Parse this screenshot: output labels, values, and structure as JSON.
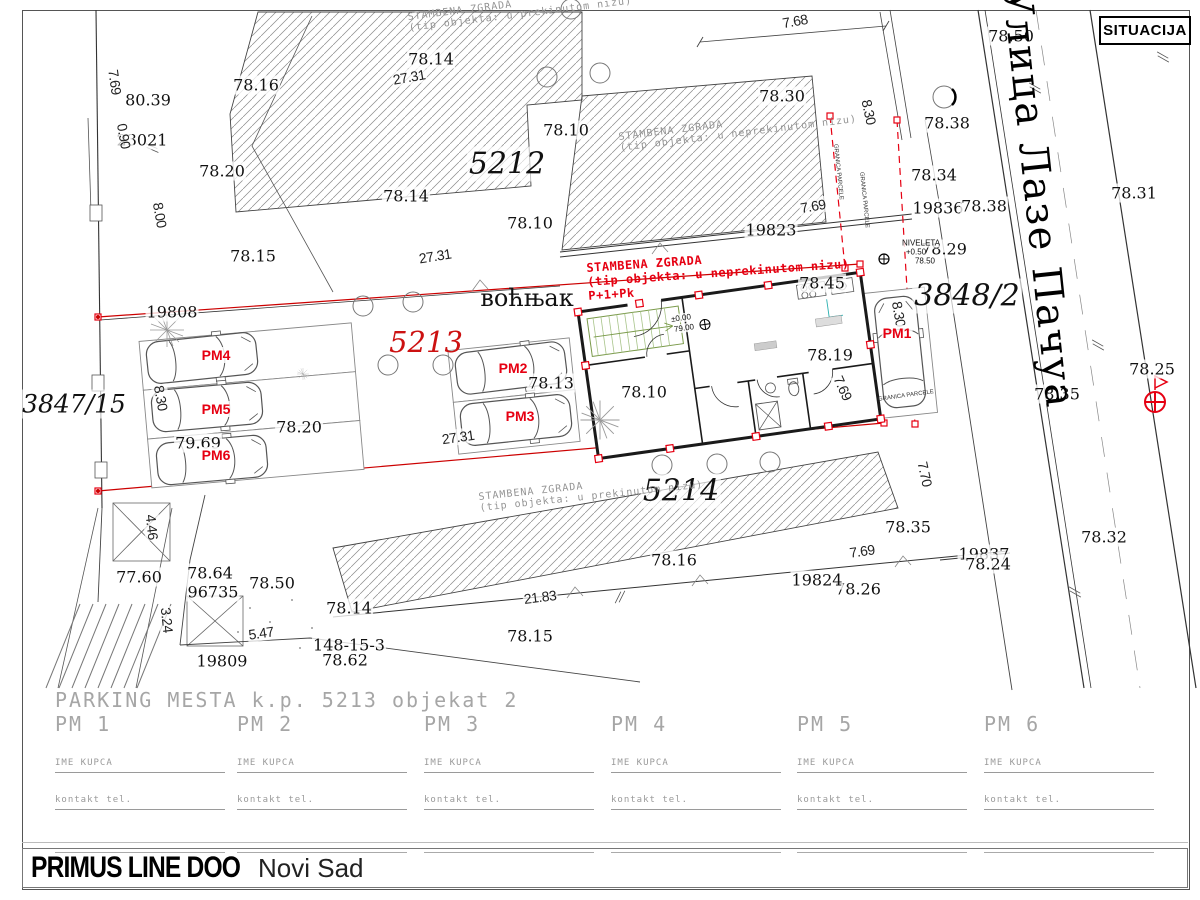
{
  "header": {
    "label": "SITUACIJA"
  },
  "street": {
    "name": "Улица Лазе Пачуа"
  },
  "colors": {
    "red": "#e60012",
    "parcel_red": "#cc1111",
    "boundary_red": "#cc0000",
    "hatch": "#777",
    "green": "#7a9a4a",
    "teal": "#2ab0b0"
  },
  "map_labels": [
    {
      "t": "78.50",
      "x": 1011,
      "y": 36,
      "c": "elev"
    },
    {
      "t": "78.16",
      "x": 256,
      "y": 85,
      "c": "elev"
    },
    {
      "t": "78.14",
      "x": 431,
      "y": 59,
      "c": "elev"
    },
    {
      "t": "80.39",
      "x": 148,
      "y": 100,
      "c": "elev"
    },
    {
      "t": "78.30",
      "x": 782,
      "y": 96,
      "c": "elev"
    },
    {
      "t": "78.38",
      "x": 947,
      "y": 123,
      "c": "elev"
    },
    {
      "t": "78.10",
      "x": 566,
      "y": 130,
      "c": "elev"
    },
    {
      "t": "23021",
      "x": 142,
      "y": 140,
      "c": "elev"
    },
    {
      "t": "78.20",
      "x": 222,
      "y": 171,
      "c": "elev"
    },
    {
      "t": "78.14",
      "x": 406,
      "y": 196,
      "c": "elev"
    },
    {
      "t": "78.34",
      "x": 934,
      "y": 175,
      "c": "elev"
    },
    {
      "t": "78.31",
      "x": 1134,
      "y": 193,
      "c": "elev"
    },
    {
      "t": "78.10",
      "x": 530,
      "y": 223,
      "c": "elev"
    },
    {
      "t": "19836",
      "x": 938,
      "y": 208,
      "c": "elev"
    },
    {
      "t": "78.38",
      "x": 984,
      "y": 206,
      "c": "elev"
    },
    {
      "t": "78.15",
      "x": 253,
      "y": 256,
      "c": "elev"
    },
    {
      "t": "78.29",
      "x": 944,
      "y": 249,
      "c": "elev"
    },
    {
      "t": "19823",
      "x": 771,
      "y": 230,
      "c": "elev"
    },
    {
      "t": "78.45",
      "x": 822,
      "y": 283,
      "c": "elev"
    },
    {
      "t": "19808",
      "x": 172,
      "y": 312,
      "c": "elev"
    },
    {
      "t": "78.13",
      "x": 551,
      "y": 383,
      "c": "elev"
    },
    {
      "t": "78.19",
      "x": 830,
      "y": 355,
      "c": "elev"
    },
    {
      "t": "78.10",
      "x": 644,
      "y": 392,
      "c": "elev"
    },
    {
      "t": "78.25",
      "x": 1152,
      "y": 369,
      "c": "elev"
    },
    {
      "t": "78.35",
      "x": 1057,
      "y": 394,
      "c": "elev"
    },
    {
      "t": "78.20",
      "x": 299,
      "y": 427,
      "c": "elev"
    },
    {
      "t": "79.69",
      "x": 198,
      "y": 443,
      "c": "elev"
    },
    {
      "t": "78.35",
      "x": 908,
      "y": 527,
      "c": "elev"
    },
    {
      "t": "78.16",
      "x": 674,
      "y": 560,
      "c": "elev"
    },
    {
      "t": "78.26",
      "x": 858,
      "y": 589,
      "c": "elev"
    },
    {
      "t": "78.32",
      "x": 1104,
      "y": 537,
      "c": "elev"
    },
    {
      "t": "19837",
      "x": 984,
      "y": 554,
      "c": "elev"
    },
    {
      "t": "78.24",
      "x": 988,
      "y": 564,
      "c": "elev"
    },
    {
      "t": "19824",
      "x": 817,
      "y": 580,
      "c": "elev"
    },
    {
      "t": "77.60",
      "x": 139,
      "y": 577,
      "c": "elev"
    },
    {
      "t": "78.64",
      "x": 210,
      "y": 573,
      "c": "elev"
    },
    {
      "t": "96735",
      "x": 213,
      "y": 592,
      "c": "elev"
    },
    {
      "t": "78.50",
      "x": 272,
      "y": 583,
      "c": "elev"
    },
    {
      "t": "78.14",
      "x": 349,
      "y": 608,
      "c": "elev"
    },
    {
      "t": "148-15-3",
      "x": 349,
      "y": 645,
      "c": "elev"
    },
    {
      "t": "78.62",
      "x": 345,
      "y": 660,
      "c": "elev"
    },
    {
      "t": "78.15",
      "x": 530,
      "y": 636,
      "c": "elev"
    },
    {
      "t": "19809",
      "x": 222,
      "y": 661,
      "c": "elev"
    },
    {
      "t": "7.68",
      "x": 795,
      "y": 21,
      "c": "dim",
      "r": -10
    },
    {
      "t": "27.31",
      "x": 409,
      "y": 77,
      "c": "dim",
      "r": -10
    },
    {
      "t": "7.69",
      "x": 115,
      "y": 82,
      "c": "dim",
      "r": 82
    },
    {
      "t": "0.90",
      "x": 124,
      "y": 136,
      "c": "dim",
      "r": 80
    },
    {
      "t": "8.00",
      "x": 160,
      "y": 215,
      "c": "dim",
      "r": 80
    },
    {
      "t": "8.30",
      "x": 869,
      "y": 112,
      "c": "dim",
      "r": 78
    },
    {
      "t": "7.69",
      "x": 813,
      "y": 206,
      "c": "dim",
      "r": -10
    },
    {
      "t": "27.31",
      "x": 435,
      "y": 256,
      "c": "dim",
      "r": -9
    },
    {
      "t": "8.30",
      "x": 161,
      "y": 398,
      "c": "dim",
      "r": 80
    },
    {
      "t": "8.30",
      "x": 899,
      "y": 314,
      "c": "dim",
      "r": 80
    },
    {
      "t": "7.69",
      "x": 843,
      "y": 388,
      "c": "dim",
      "r": 66
    },
    {
      "t": "27.31",
      "x": 458,
      "y": 437,
      "c": "dim",
      "r": -8
    },
    {
      "t": "7.70",
      "x": 925,
      "y": 474,
      "c": "dim",
      "r": 78
    },
    {
      "t": "7.69",
      "x": 862,
      "y": 551,
      "c": "dim",
      "r": -8
    },
    {
      "t": "21.83",
      "x": 540,
      "y": 597,
      "c": "dim",
      "r": -7
    },
    {
      "t": "4.46",
      "x": 152,
      "y": 527,
      "c": "dim",
      "r": 84
    },
    {
      "t": "3.24",
      "x": 167,
      "y": 620,
      "c": "dim",
      "r": 84
    },
    {
      "t": "5.47",
      "x": 261,
      "y": 633,
      "c": "dim",
      "r": -8
    },
    {
      "t": "5212",
      "x": 507,
      "y": 164,
      "c": "parcel"
    },
    {
      "t": "5214",
      "x": 681,
      "y": 491,
      "c": "parcel"
    },
    {
      "t": "3848/2",
      "x": 967,
      "y": 296,
      "c": "parcel"
    },
    {
      "t": "3847/15",
      "x": 74,
      "y": 404,
      "c": "parcel parcelSm"
    },
    {
      "t": "5213",
      "x": 426,
      "y": 342,
      "c": "parcelRed"
    },
    {
      "t": "воћњак",
      "x": 527,
      "y": 298,
      "c": "vocnjak"
    },
    {
      "t": "PM1",
      "x": 897,
      "y": 333,
      "c": "pm"
    },
    {
      "t": "PM2",
      "x": 513,
      "y": 368,
      "c": "pm"
    },
    {
      "t": "PM3",
      "x": 520,
      "y": 416,
      "c": "pm"
    },
    {
      "t": "PM4",
      "x": 216,
      "y": 355,
      "c": "pm"
    },
    {
      "t": "PM5",
      "x": 216,
      "y": 409,
      "c": "pm"
    },
    {
      "t": "PM6",
      "x": 216,
      "y": 455,
      "c": "pm"
    },
    {
      "t": "±0.00",
      "x": 681,
      "y": 318,
      "c": "tiny",
      "r": -8
    },
    {
      "t": "79.00",
      "x": 684,
      "y": 328,
      "c": "tiny",
      "r": -8
    },
    {
      "t": "NIVELETA",
      "x": 921,
      "y": 243,
      "c": "tiny"
    },
    {
      "t": "+0.50",
      "x": 916,
      "y": 252,
      "c": "tiny"
    },
    {
      "t": "78.50",
      "x": 925,
      "y": 261,
      "c": "tiny"
    },
    {
      "t": "GRANICA PARCELE",
      "x": 864,
      "y": 200,
      "c": "micro",
      "r": 84
    },
    {
      "t": "GRANICA PARCELE",
      "x": 838,
      "y": 172,
      "c": "micro",
      "r": 84
    },
    {
      "t": "GRANICA PARCELE",
      "x": 906,
      "y": 396,
      "c": "micro",
      "r": -8
    },
    {
      "t": "Улица Лазе Пачуа",
      "x": 1038,
      "y": 198,
      "c": "street",
      "r": 84
    }
  ],
  "notes": [
    {
      "cls": "gray",
      "x": 407,
      "y": 12,
      "r": -7,
      "lines": [
        "STAMBENA ZGRADA",
        "(tip objekta: u prekinutom nizu)"
      ]
    },
    {
      "cls": "gray",
      "x": 618,
      "y": 132,
      "r": -7,
      "lines": [
        "STAMBENA ZGRADA",
        "(tip objekta: u neprekinutom nizu)"
      ]
    },
    {
      "cls": "gray",
      "x": 478,
      "y": 492,
      "r": -6,
      "lines": [
        "STAMBENA ZGRADA",
        "(tip objekta: u prekinutom nizu)"
      ]
    },
    {
      "cls": "red",
      "x": 586,
      "y": 262,
      "r": -4,
      "lines": [
        "STAMBENA ZGRADA",
        "(tip objekta: u neprekinutom nizu)",
        "P+1+Pk"
      ]
    }
  ],
  "parking_table": {
    "title": "PARKING MESTA k.p. 5213  objekat 2",
    "columns": [
      "PM 1",
      "PM 2",
      "PM 3",
      "PM 4",
      "PM 5",
      "PM 6"
    ],
    "column_x": [
      55,
      237,
      424,
      611,
      797,
      984
    ],
    "field1": "IME KUPCA",
    "field2": "kontakt tel."
  },
  "title_block": {
    "company": "PRIMUS LINE DOO",
    "city": "Novi Sad"
  }
}
